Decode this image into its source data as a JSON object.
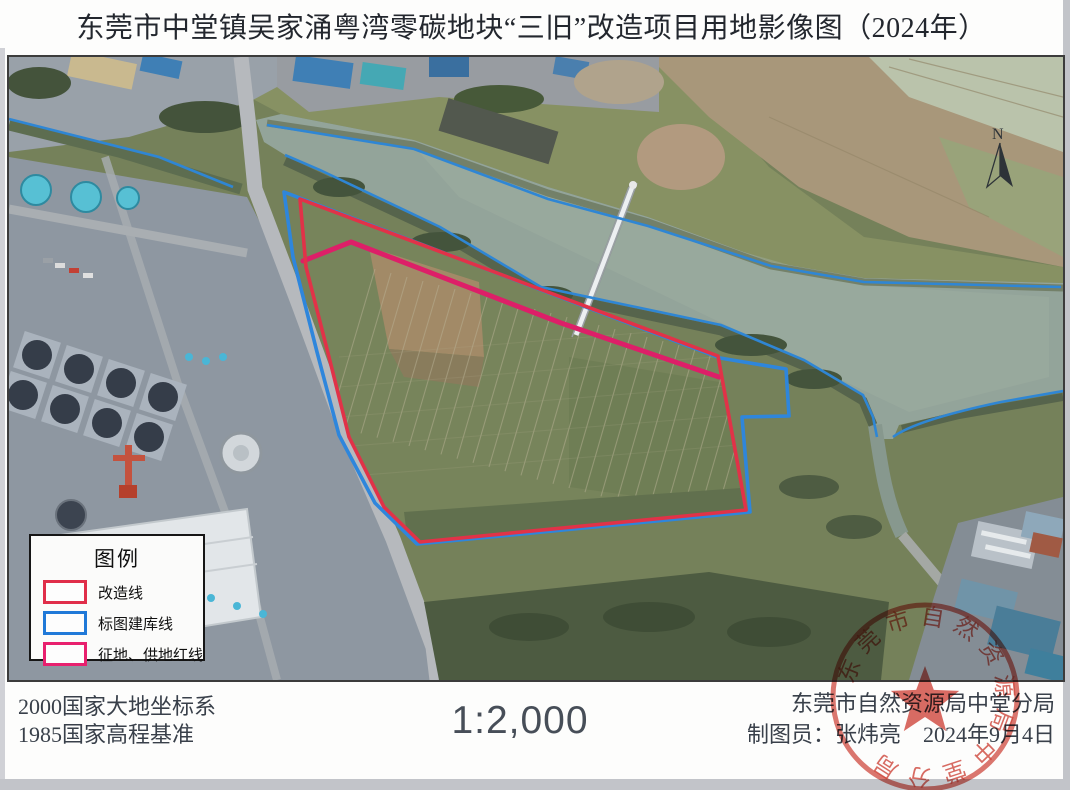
{
  "title": "东莞市中堂镇吴家涌粤湾零碳地块“三旧”改造项目用地影像图（2024年）",
  "map": {
    "north_label": "N",
    "legend": {
      "title": "图例",
      "items": [
        {
          "label": "改造线",
          "color": "#e02e4a"
        },
        {
          "label": "标图建库线",
          "color": "#2079d8"
        },
        {
          "label": "征地、供地红线",
          "color": "#e8206e"
        }
      ]
    },
    "overlay_colors": {
      "renovation_line": "#e13248",
      "mapping_database_line": "#2e86dc",
      "land_supply_red_line": "#dd1f68"
    }
  },
  "footer": {
    "datum_line1": "2000国家大地坐标系",
    "datum_line2": "1985国家高程基准",
    "scale": "1:2,000",
    "agency": "东莞市自然资源局中堂分局",
    "cartographer_label": "制图员：",
    "cartographer_name": "张炜亮",
    "date": "2024年9月4日"
  },
  "stamp": {
    "text": "东莞市自然资源局中堂分局",
    "color": "#cf4338"
  }
}
